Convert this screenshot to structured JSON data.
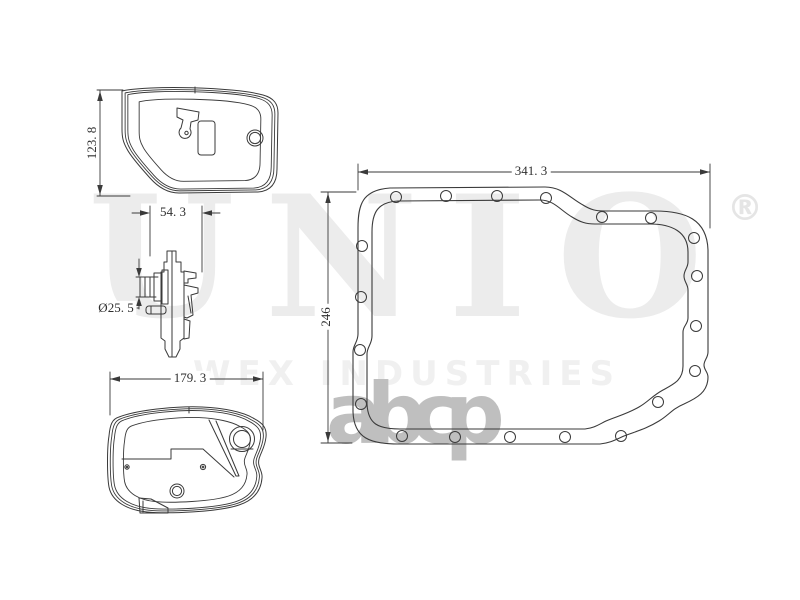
{
  "watermark": {
    "brand": "UNIO",
    "registered": "®",
    "subtitle": "WEX INDUSTRIES",
    "logo_text": "abcp"
  },
  "dimensions": {
    "filter_height": "123. 8",
    "filter_side_width": "54. 3",
    "hub_diameter": "Ø25. 5",
    "filter_bottom_width": "179. 3",
    "gasket_width": "341. 3",
    "gasket_height": "246"
  },
  "colors": {
    "background": "#ffffff",
    "line": "#3a3a3a",
    "dimension_text": "#2f2f2f",
    "watermark_brand": "#ececec",
    "watermark_registered": "#e5e5e5",
    "watermark_subtitle": "#f0f0f0",
    "watermark_logo": "#bfbfbf"
  }
}
